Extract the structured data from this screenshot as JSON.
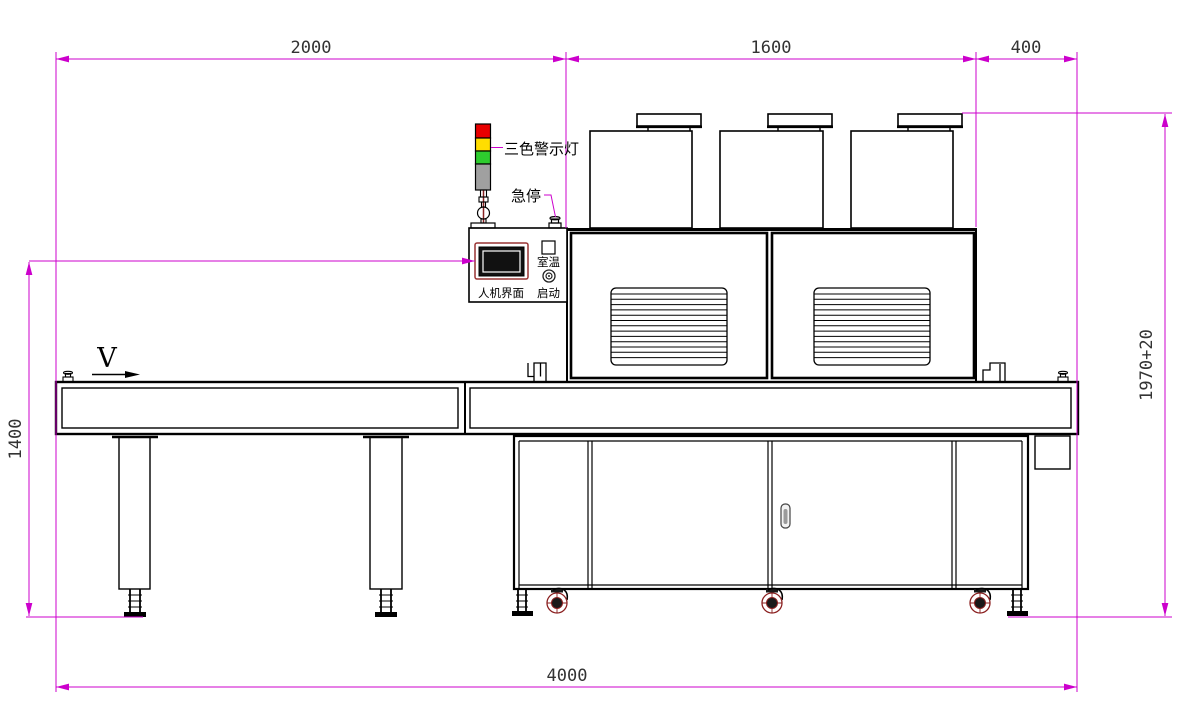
{
  "drawing": {
    "dimensions": {
      "infeed_length": "2000",
      "oven_length": "1600",
      "outfeed_length": "400",
      "conveyor_height": "1400",
      "machine_height": "1970+20",
      "total_length": "4000"
    },
    "labels": {
      "tricolor_warning_light": "三色警示灯",
      "emergency_stop": "急停",
      "room_temperature": "室温",
      "start_button": "启动",
      "hmi_panel": "人机界面",
      "conveyor_direction": "V"
    },
    "colors": {
      "dimension_line": "#CC00CC",
      "outline": "#000000",
      "light_red": "#E80000",
      "light_yellow": "#FFDD00",
      "light_green": "#2ECC2E",
      "light_base_gray": "#A0A0A0",
      "screen_border_maroon": "#993333",
      "caster_red": "#8B2020"
    }
  }
}
